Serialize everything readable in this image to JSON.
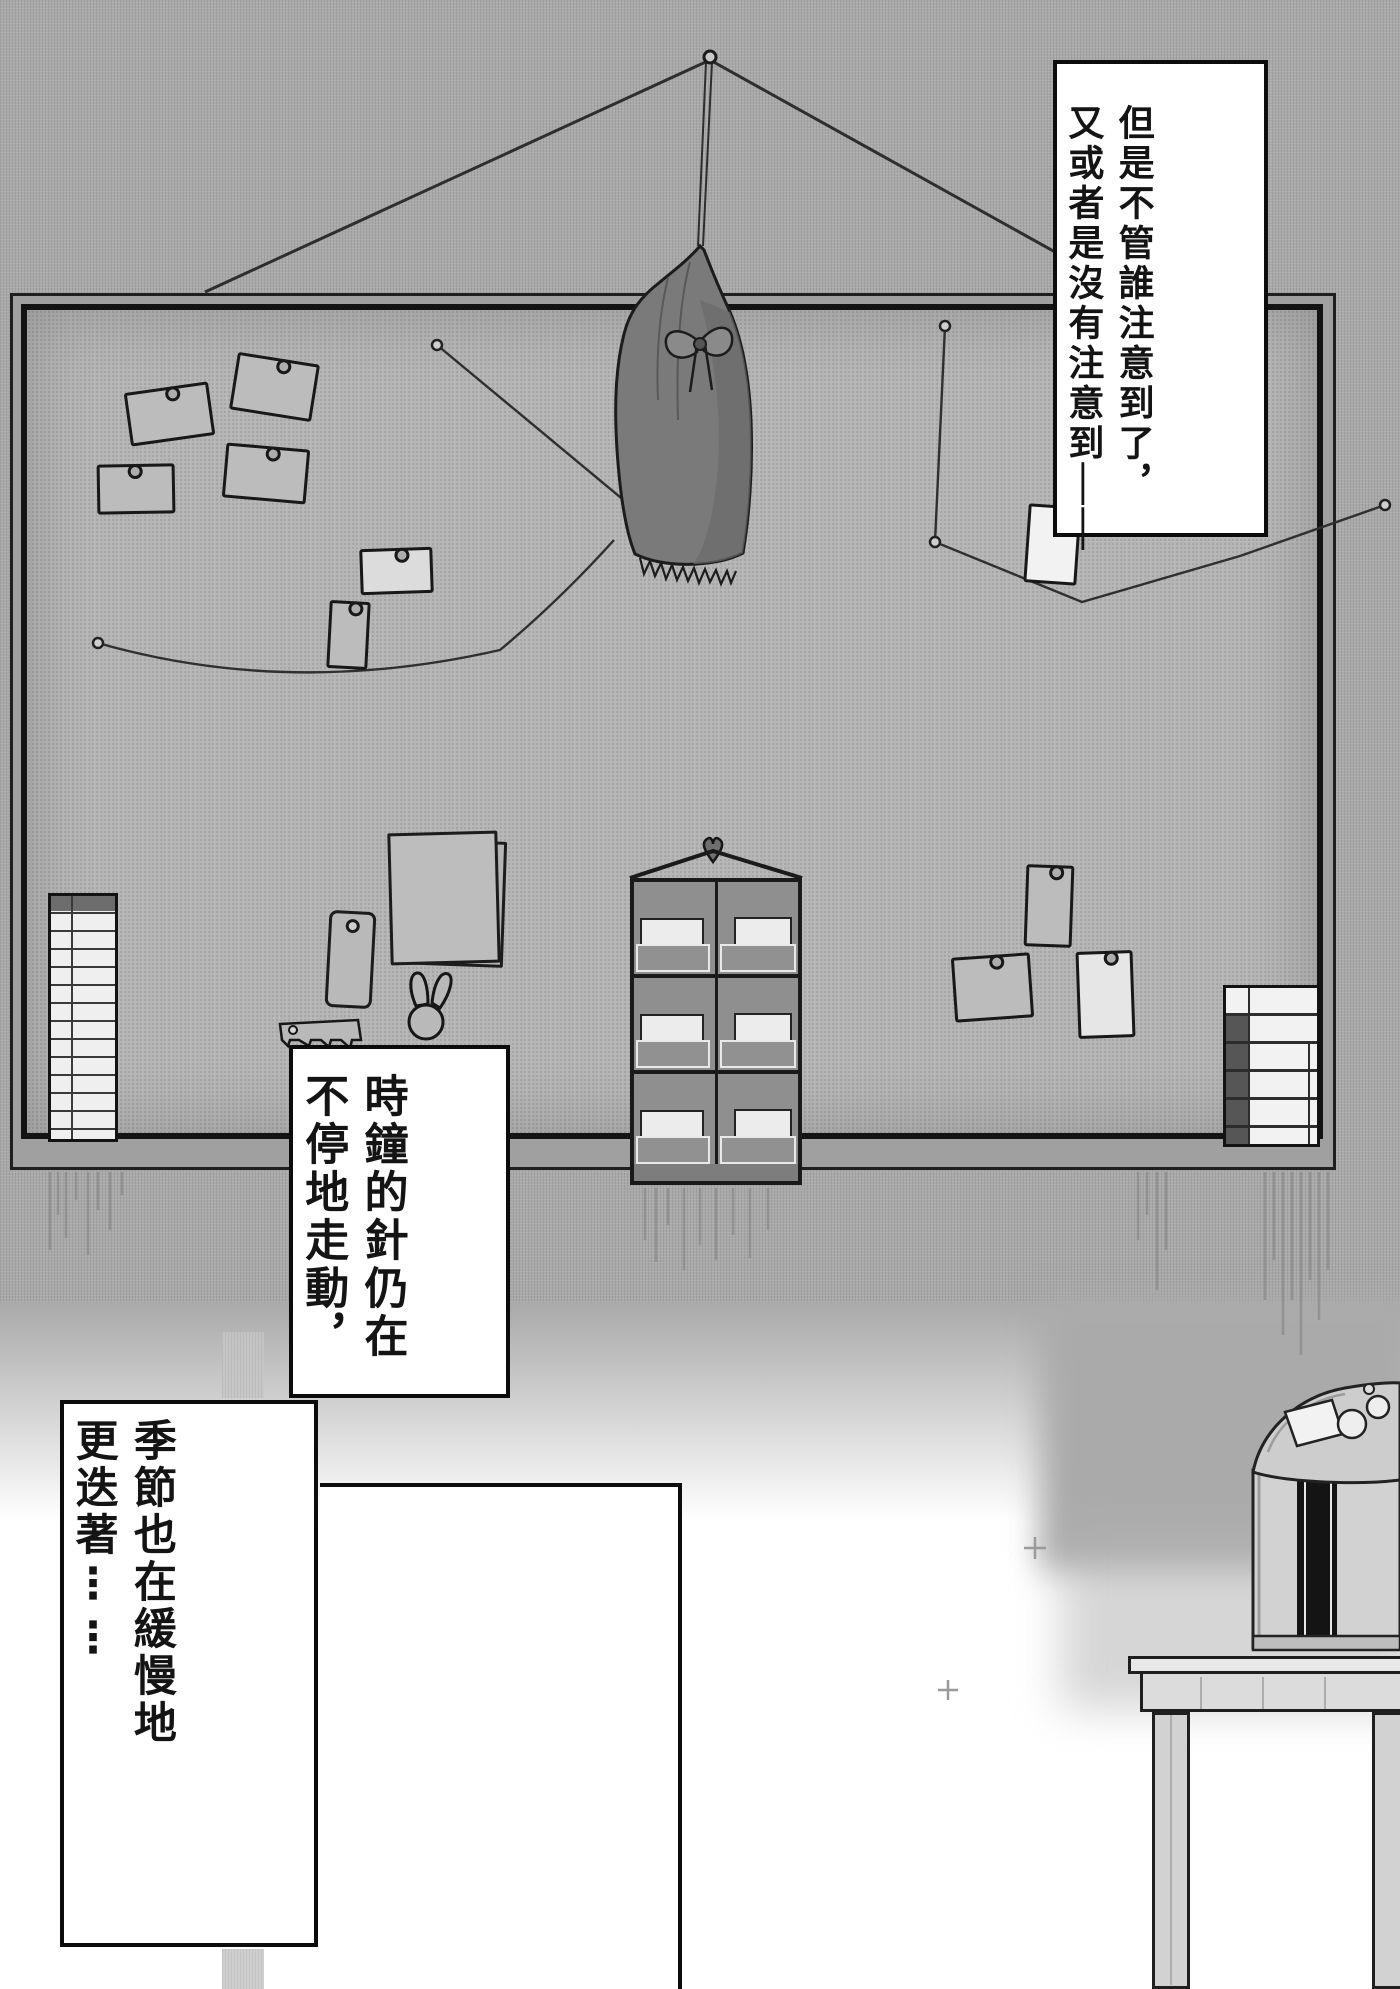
{
  "page": {
    "type": "manga-page",
    "language": "zh-TW",
    "width_px": 1400,
    "height_px": 1989
  },
  "narration_boxes": [
    {
      "id": "narration-top-right",
      "columns": [
        "但是不管誰注意到了，",
        "又或者是沒有注意到——"
      ]
    },
    {
      "id": "narration-clock",
      "columns": [
        "時鐘的針仍在",
        "不停地走動，"
      ]
    },
    {
      "id": "narration-season",
      "columns": [
        "季節也在緩慢地",
        "更迭著……"
      ]
    },
    {
      "id": "narration-empty",
      "columns": []
    }
  ],
  "scene": {
    "description": "A cork bulletin board hangs on a wall from a nail by a V-shaped wire; a dark drawstring pouch hangs from the nail over the board. Note cards, garland strings with push pins, two small calendars, a pocket organizer with a heart-shaped pin, a bunny clip, a ruler and papers are pinned to the board. Below right, a rice cooker sits on a wooden stand.",
    "objects": [
      {
        "name": "nail-hook",
        "type": "pin"
      },
      {
        "name": "hanging-wire",
        "type": "string"
      },
      {
        "name": "drawstring-bag",
        "type": "hanging-pouch"
      },
      {
        "name": "note-cards",
        "type": "pinned-card",
        "count": 10
      },
      {
        "name": "garland-strings",
        "type": "string",
        "count": 3
      },
      {
        "name": "push-pins",
        "type": "pin",
        "count": 5
      },
      {
        "name": "calendar-left",
        "type": "list-calendar"
      },
      {
        "name": "calendar-right",
        "type": "grid-calendar"
      },
      {
        "name": "pocket-organizer",
        "type": "wall-organizer",
        "rows": 3,
        "columns": 2
      },
      {
        "name": "heart-pin",
        "type": "pin"
      },
      {
        "name": "memo-tag",
        "type": "hanging-tag"
      },
      {
        "name": "ruler-clip",
        "type": "ruler"
      },
      {
        "name": "bunny-clip",
        "type": "rabbit-shaped-clip"
      },
      {
        "name": "paper-stack",
        "type": "note-papers"
      },
      {
        "name": "shadow-drips",
        "type": "decoration"
      },
      {
        "name": "sparkles",
        "type": "decoration",
        "count": 2
      },
      {
        "name": "rice-cooker",
        "type": "appliance"
      },
      {
        "name": "wooden-stand",
        "type": "furniture"
      }
    ]
  },
  "colors": {
    "ink": "#141414",
    "wall": "#a9a9a9",
    "board": "#b5b5b5",
    "paper": "#ffffff",
    "bag": "#7a7a7a"
  }
}
